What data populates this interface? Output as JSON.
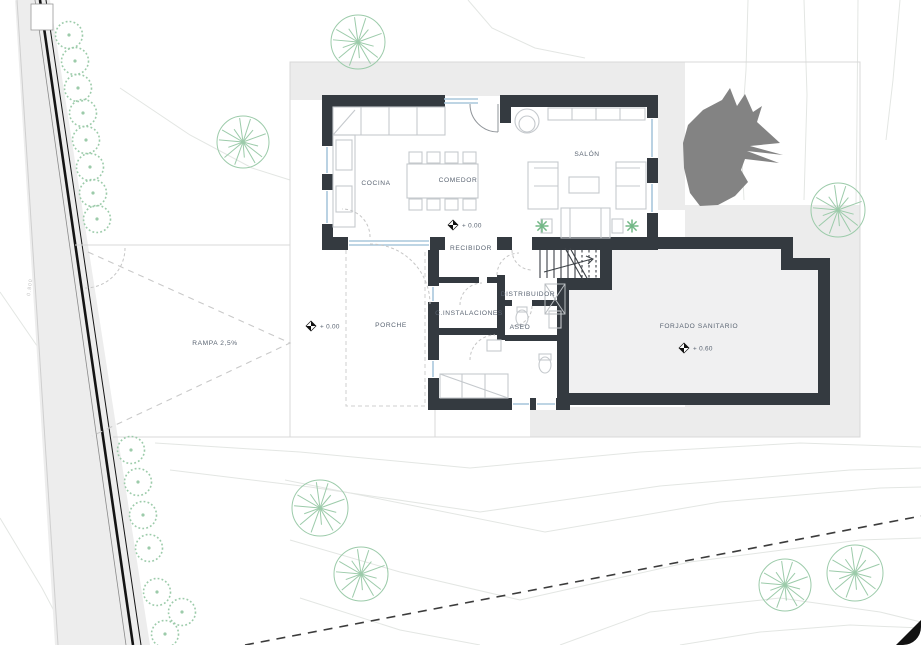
{
  "title": "Planta baja - plano de situación",
  "plan": {
    "rooms": [
      {
        "id": "cocina",
        "label": "COCINA",
        "x": 376,
        "y": 185
      },
      {
        "id": "comedor",
        "label": "COMEDOR",
        "x": 458,
        "y": 182
      },
      {
        "id": "salon",
        "label": "SALÓN",
        "x": 587,
        "y": 156
      },
      {
        "id": "recibidor",
        "label": "RECIBIDOR",
        "x": 471,
        "y": 250
      },
      {
        "id": "distribuidor",
        "label": "DISTRIBUIDOR",
        "x": 528,
        "y": 296
      },
      {
        "id": "instalaciones",
        "label": "C.INSTALACIONES",
        "x": 469,
        "y": 315
      },
      {
        "id": "aseo",
        "label": "ASEO",
        "x": 520,
        "y": 329
      },
      {
        "id": "porche",
        "label": "PORCHE",
        "x": 391,
        "y": 327
      },
      {
        "id": "forjado",
        "label": "FORJADO SANITARIO",
        "x": 699,
        "y": 328
      }
    ],
    "levels": [
      {
        "label": "+ 0.00",
        "dx": 453,
        "dy": 225
      },
      {
        "label": "+ 0.00",
        "dx": 311,
        "dy": 326
      },
      {
        "label": "+ 0.60",
        "dx": 684,
        "dy": 348
      }
    ],
    "ramp_label": "RAMPA 2,5%",
    "road_label": "0.800",
    "plants": [
      [
        542,
        226
      ],
      [
        632,
        226
      ]
    ]
  },
  "site": {
    "hedges": [
      [
        69,
        35
      ],
      [
        75,
        61
      ],
      [
        78,
        88
      ],
      [
        83,
        113
      ],
      [
        86,
        140
      ],
      [
        90,
        167
      ],
      [
        93,
        193
      ],
      [
        97,
        219
      ],
      [
        131,
        450
      ],
      [
        138,
        482
      ],
      [
        143,
        515
      ],
      [
        149,
        548
      ],
      [
        157,
        592
      ],
      [
        182,
        612
      ],
      [
        165,
        634
      ]
    ],
    "trees": [
      [
        358,
        42,
        27
      ],
      [
        243,
        142,
        26
      ],
      [
        838,
        210,
        27
      ],
      [
        320,
        508,
        28
      ],
      [
        361,
        574,
        27
      ],
      [
        785,
        585,
        26
      ],
      [
        855,
        573,
        28
      ]
    ],
    "contours": [
      "748,0 746,70 741,140 744,200",
      "804,0 807,95 804,200",
      "858,0 857,120 856,204",
      "900,0 893,80 886,140",
      "468,0 492,28 535,48 585,58",
      "120,88 190,135 252,168 290,180",
      "0,292 55,372 100,437",
      "0,518 42,588 72,645",
      "155,443 300,452 470,468 640,452 800,443 921,447",
      "170,470 310,487 480,512 660,486 850,470 921,468",
      "285,480 410,505 545,532 720,502 880,488 921,487",
      "290,540 400,572 520,600 690,562 860,540 921,538",
      "300,598 400,630 480,645",
      "560,645 650,612 780,598 880,612 921,622",
      "680,645 760,632 850,625 921,628"
    ],
    "boundary": "245,645 921,516",
    "ramp_chevron": "88,252 290,343 92,436",
    "blob": "688,125 703,110 722,100 730,88 737,106 745,94 753,112 762,106 757,122 780,143 750,146 783,155 747,151 779,163 745,159 741,170 748,182 735,196 718,205 700,206 690,193 684,168 683,143"
  },
  "colors": {
    "wall": "#343a40",
    "glass": "#a9c7dc",
    "furn": "#c5c9cd",
    "label": "#5a6472",
    "green": "#9ccbaa",
    "plant": "#72b886",
    "platform": "#ececec",
    "room_gray": "#f0f0f1",
    "road": "#ededed",
    "contour": "#e3e6e3",
    "blob": "#838383",
    "boundary": "#3c3c3c"
  }
}
